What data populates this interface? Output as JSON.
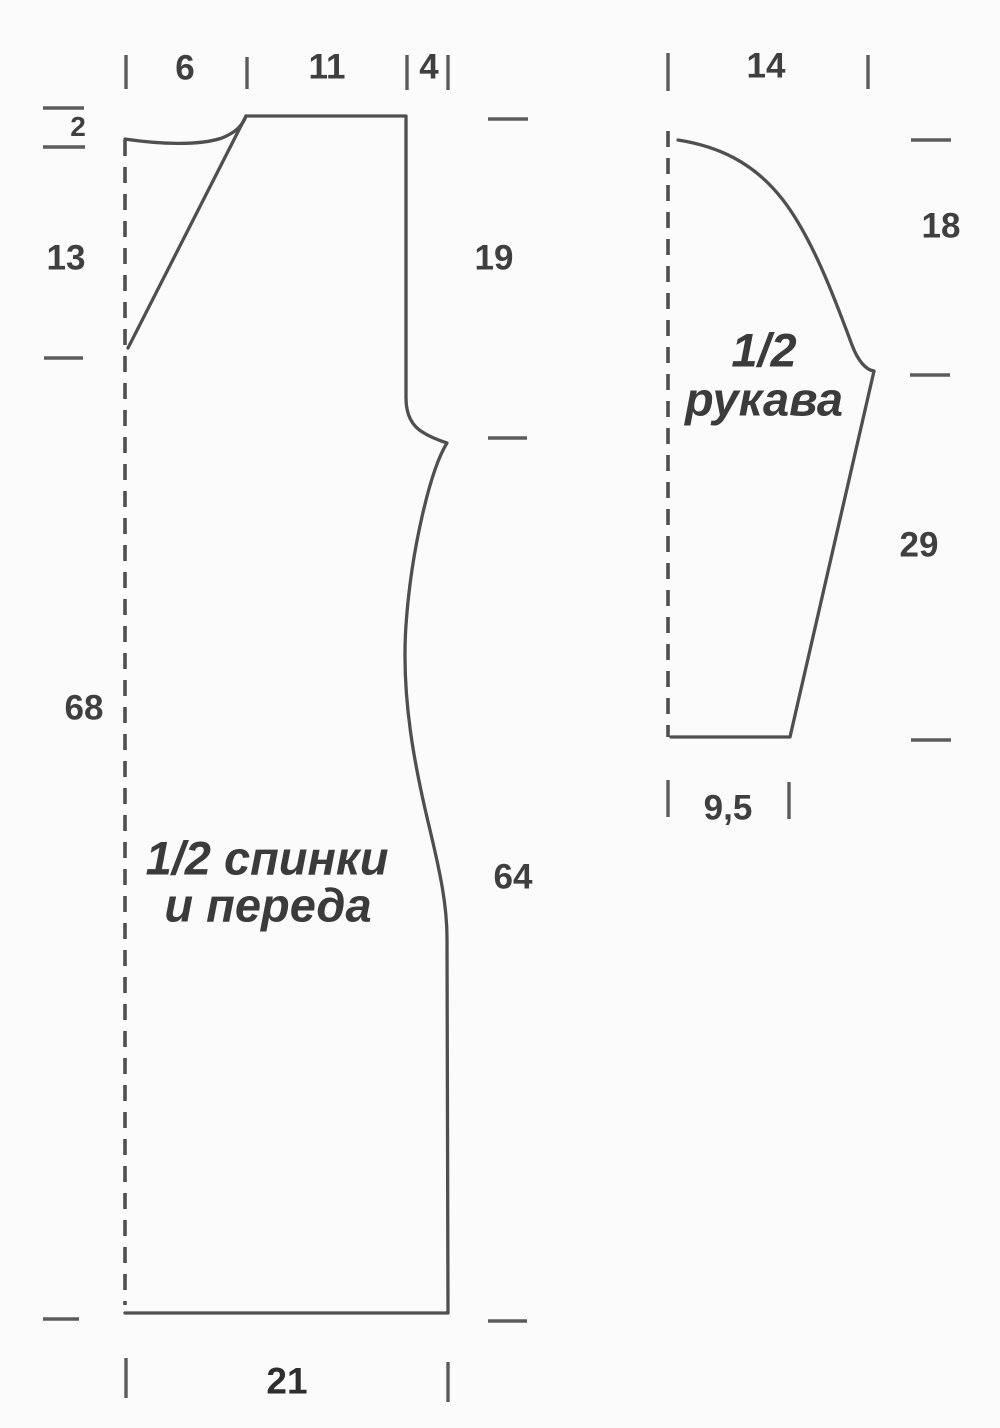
{
  "body_piece": {
    "name_line1": "1/2 спинки",
    "name_line2": "и переда",
    "measurements": {
      "neck_half_width": "6",
      "shoulder_top_width": "11",
      "armhole_inset": "4",
      "neck_depth": "2",
      "raglan_depth": "13",
      "fold_side_length": "68",
      "upper_side_length": "19",
      "lower_side_length": "64",
      "hem_half_width": "21"
    }
  },
  "sleeve_piece": {
    "name_line1": "1/2",
    "name_line2": "рукава",
    "measurements": {
      "top_half_width": "14",
      "cap_height": "18",
      "underarm_seam_length": "29",
      "cuff_half_width": "9,5"
    }
  },
  "colors": {
    "outline": "#4f4f4f",
    "tick": "#5c5c5c",
    "text": "#3f3f3f",
    "background": "#fbfbfb"
  }
}
